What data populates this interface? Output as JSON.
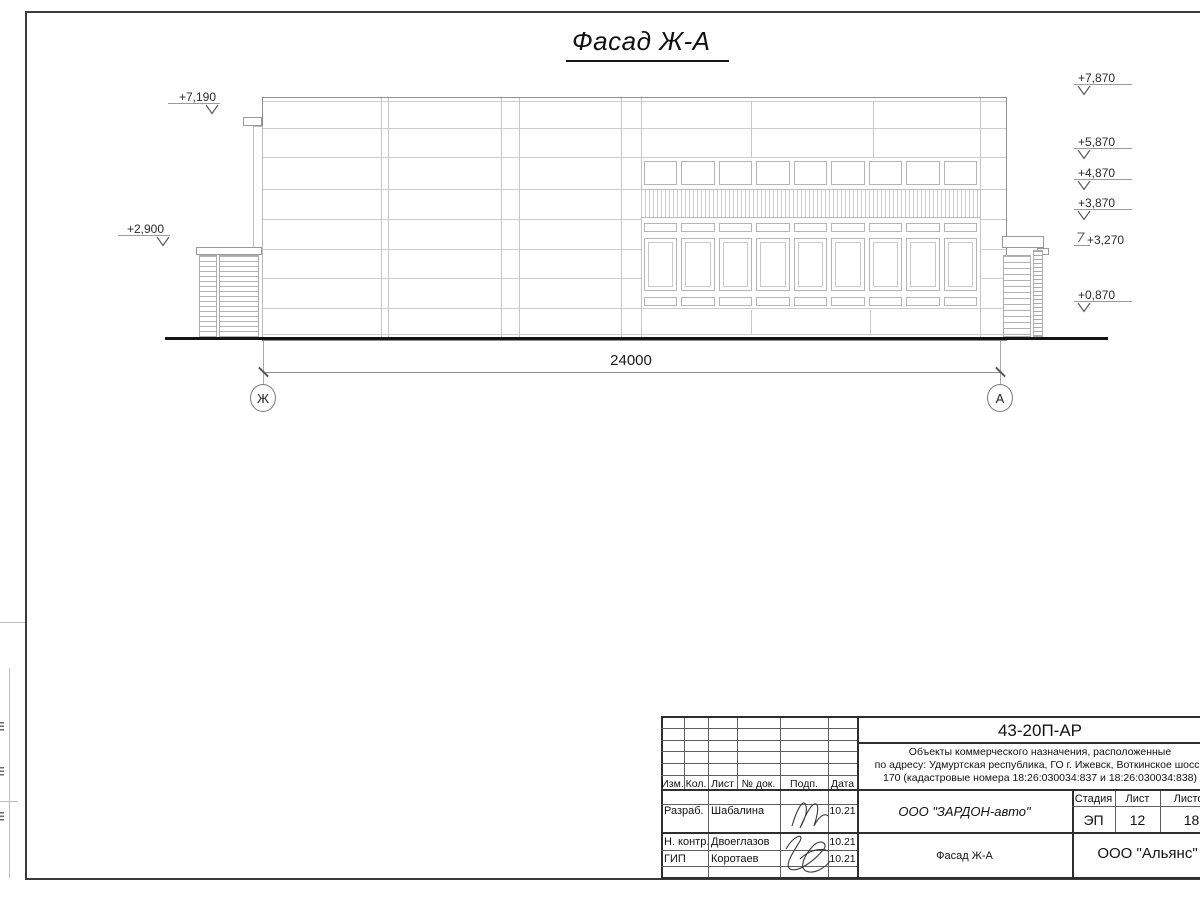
{
  "sheet": {
    "view_title": "Фасад Ж-А",
    "dimension_label": "24000",
    "axis_bubbles": [
      {
        "label": "Ж"
      },
      {
        "label": "А"
      }
    ],
    "elevations_left": [
      {
        "label": "+7,190"
      },
      {
        "label": "+2,900"
      }
    ],
    "elevations_right": [
      {
        "label": "+7,870"
      },
      {
        "label": "+5,870"
      },
      {
        "label": "+4,870"
      },
      {
        "label": "+3,870"
      },
      {
        "label": "+3,270"
      },
      {
        "label": "+0,870"
      }
    ]
  },
  "title_block": {
    "document_code": "43-20П-АР",
    "project_description": {
      "line1": "Объекты коммерческого назначения, расположенные",
      "line2": "по адресу: Удмуртская республика, ГО г. Ижевск, Воткинское шоссе",
      "line3": "170 (кадастровые номера 18:26:030034:837 и 18:26:030034:838)"
    },
    "columns": {
      "izm": "Изм.",
      "kol": "Кол.",
      "list": "Лист",
      "doc_num": "№ док.",
      "podp": "Подп.",
      "date": "Дата"
    },
    "signers": [
      {
        "role": "Разраб.",
        "name": "Шабалина",
        "date": "10.21"
      },
      {
        "role": "Н. контр.",
        "name": "Двоеглазов",
        "date": "10.21"
      },
      {
        "role": "ГИП",
        "name": "Коротаев",
        "date": "10.21"
      }
    ],
    "stage_header": {
      "stage": "Стадия",
      "sheet": "Лист",
      "sheets": "Листов"
    },
    "stage_values": {
      "stage": "ЭП",
      "sheet": "12",
      "sheets": "18"
    },
    "client_org": "ООО \"ЗАРДОН-авто\"",
    "sheet_name": "Фасад Ж-А",
    "design_org": "ООО \"Альянс\""
  }
}
